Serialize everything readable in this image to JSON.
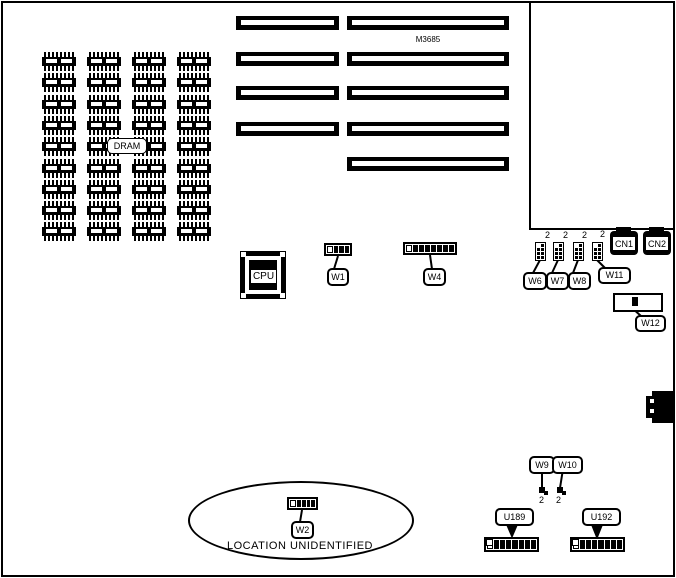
{
  "board": {
    "model": "M3685"
  },
  "labels": {
    "dram": "DRAM",
    "cpu": "CPU",
    "location_note": "LOCATION UNIDENTIFIED",
    "pin2": "2"
  },
  "slots": {
    "left_count": 4,
    "right_count": 5
  },
  "dram_grid": {
    "columns": 4,
    "rows": 9
  },
  "pin_blocks": {
    "rows": 4,
    "cols": 2
  },
  "jumpers": {
    "w1": {
      "label": "W1",
      "cells": 4
    },
    "w2": {
      "label": "W2",
      "cells": 5
    },
    "w4": {
      "label": "W4",
      "cells": 8
    },
    "w6": {
      "label": "W6"
    },
    "w7": {
      "label": "W7"
    },
    "w8": {
      "label": "W8"
    },
    "w9": {
      "label": "W9"
    },
    "w10": {
      "label": "W10"
    },
    "w11": {
      "label": "W11"
    },
    "w12": {
      "label": "W12"
    }
  },
  "connectors": {
    "cn1": "CN1",
    "cn2": "CN2"
  },
  "ics": {
    "u189": {
      "label": "U189",
      "cells": 8
    },
    "u192": {
      "label": "U192",
      "cells": 8
    }
  },
  "colors": {
    "ink": "#000000",
    "paper": "#ffffff"
  }
}
